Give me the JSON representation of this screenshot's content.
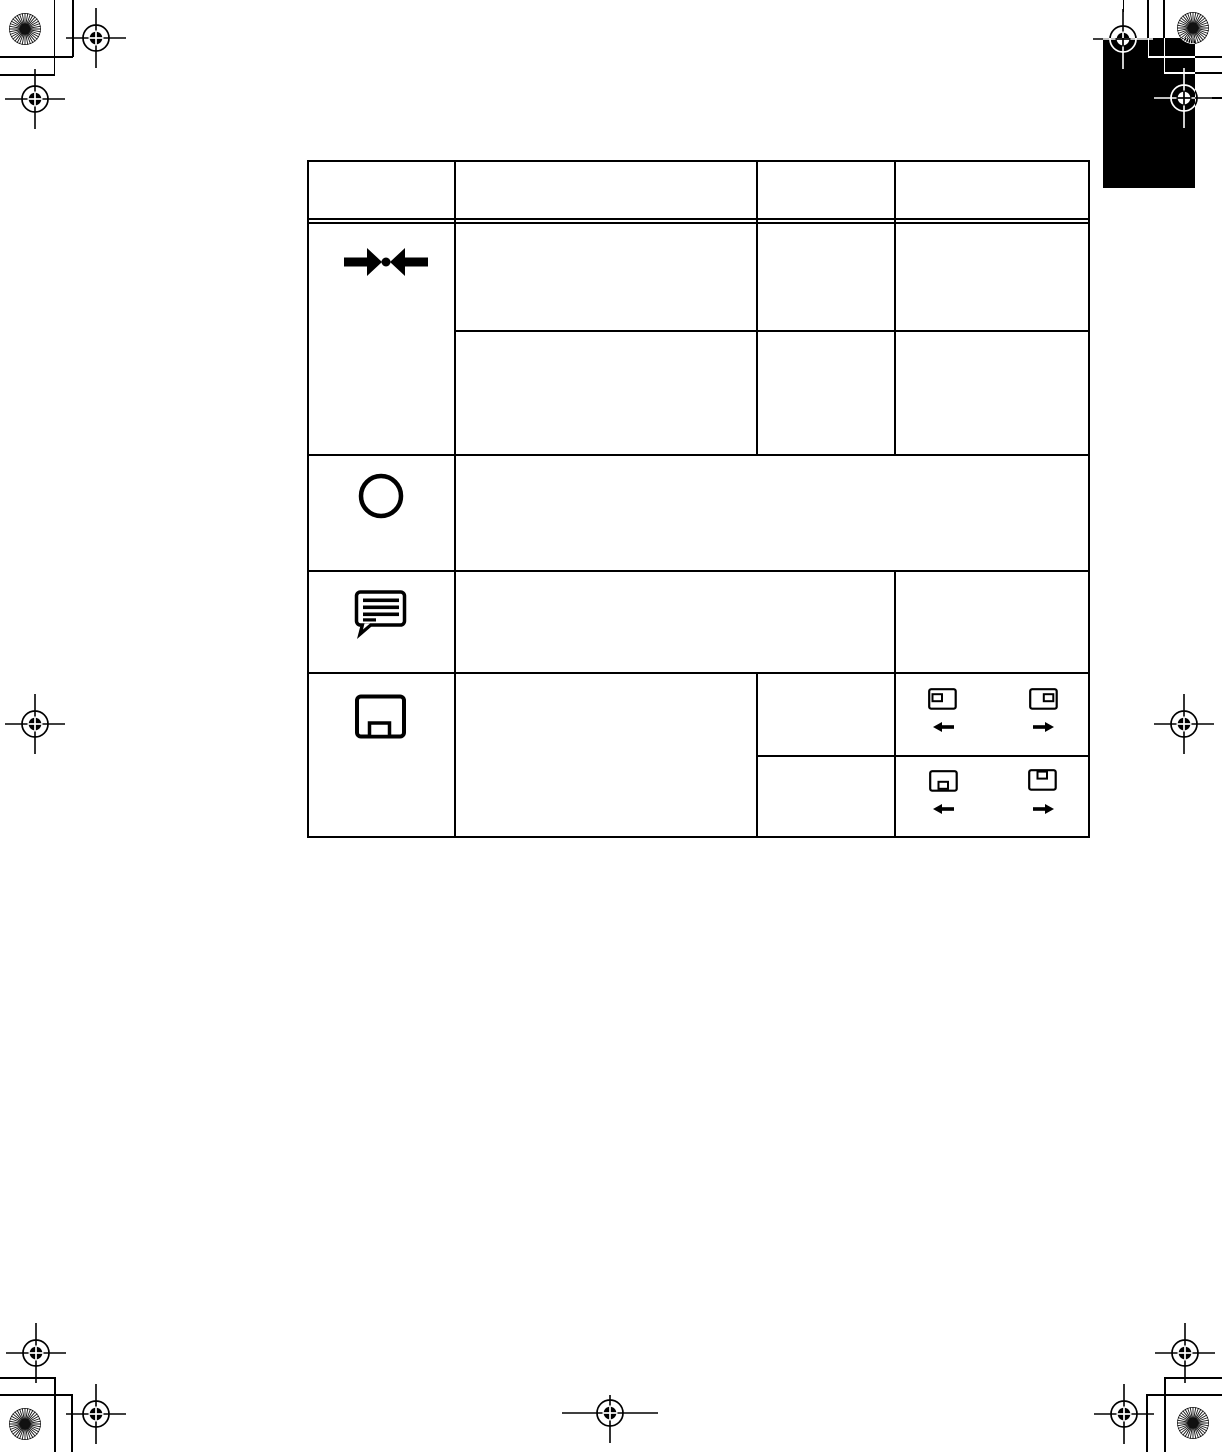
{
  "page": {
    "background_color": "#ffffff",
    "ink_color": "#000000",
    "chapter_tab_color": "#000000"
  },
  "table": {
    "columns": 4,
    "header_cells": [
      "",
      "",
      "",
      ""
    ],
    "rows": [
      {
        "row_icon": "compress-arrows-icon",
        "sub_rows": [
          {
            "cells": [
              "",
              "",
              ""
            ]
          },
          {
            "cells": [
              "",
              "",
              ""
            ]
          }
        ]
      },
      {
        "row_icon": "circle-icon",
        "cells": [
          ""
        ]
      },
      {
        "row_icon": "speech-bubble-icon",
        "cells": [
          "",
          ""
        ]
      },
      {
        "row_icon": "screen-menu-icon",
        "sub_rows": [
          {
            "cells": [
              "",
              ""
            ],
            "controls": {
              "left_icon": "screen-box-left-icon",
              "left_arrow": "left-arrow-icon",
              "right_icon": "screen-box-right-icon",
              "right_arrow": "right-arrow-icon"
            }
          },
          {
            "cells": [
              "",
              ""
            ],
            "controls": {
              "left_icon": "screen-box-bottom-icon",
              "left_arrow": "left-arrow-icon",
              "right_icon": "screen-box-top-icon",
              "right_arrow": "right-arrow-icon"
            }
          }
        ]
      }
    ]
  },
  "printer_marks": {
    "registration_mark": "registration-crosshair-icon",
    "sunburst_mark": "sunburst-circle-icon",
    "registration_mark_count": 11,
    "sunburst_mark_count": 4,
    "corner_trim_marks": true
  }
}
